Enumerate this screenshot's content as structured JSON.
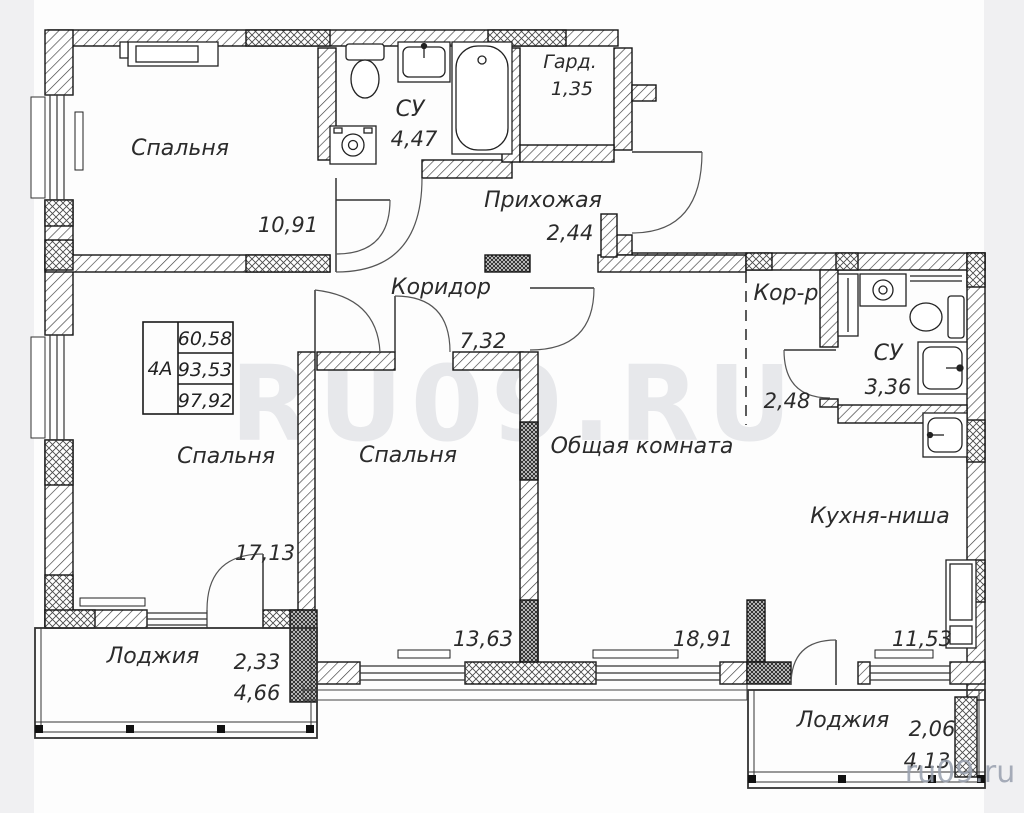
{
  "plan": {
    "watermark_large": "RU09.RU",
    "watermark_small": "ru09.ru",
    "info_box": {
      "unit": "4А",
      "area_living": "60,58",
      "area_main": "93,53",
      "area_total": "97,92"
    },
    "rooms": {
      "bedroom_top": {
        "name": "Спальня",
        "area": "10,91"
      },
      "bathroom_top": {
        "name": "СУ",
        "area": "4,47"
      },
      "wardrobe": {
        "name": "Гард.",
        "area": "1,35"
      },
      "hallway": {
        "name": "Прихожая",
        "area": "2,44"
      },
      "corridor": {
        "name": "Коридор",
        "area": "7,32"
      },
      "corridor_small": {
        "name": "Кор-р",
        "area": "2,48"
      },
      "bathroom_right": {
        "name": "СУ",
        "area": "3,36"
      },
      "bedroom_left": {
        "name": "Спальня",
        "area": "17,13"
      },
      "bedroom_middle": {
        "name": "Спальня",
        "area": "13,63"
      },
      "living_room": {
        "name": "Общая комната",
        "area": "18,91"
      },
      "kitchen": {
        "name": "Кухня-ниша",
        "area": "11,53"
      },
      "loggia_left": {
        "name": "Лоджия",
        "area_half": "2,33",
        "area_full": "4,66"
      },
      "loggia_right": {
        "name": "Лоджия",
        "area_half": "2,06",
        "area_full": "4,13"
      }
    }
  }
}
